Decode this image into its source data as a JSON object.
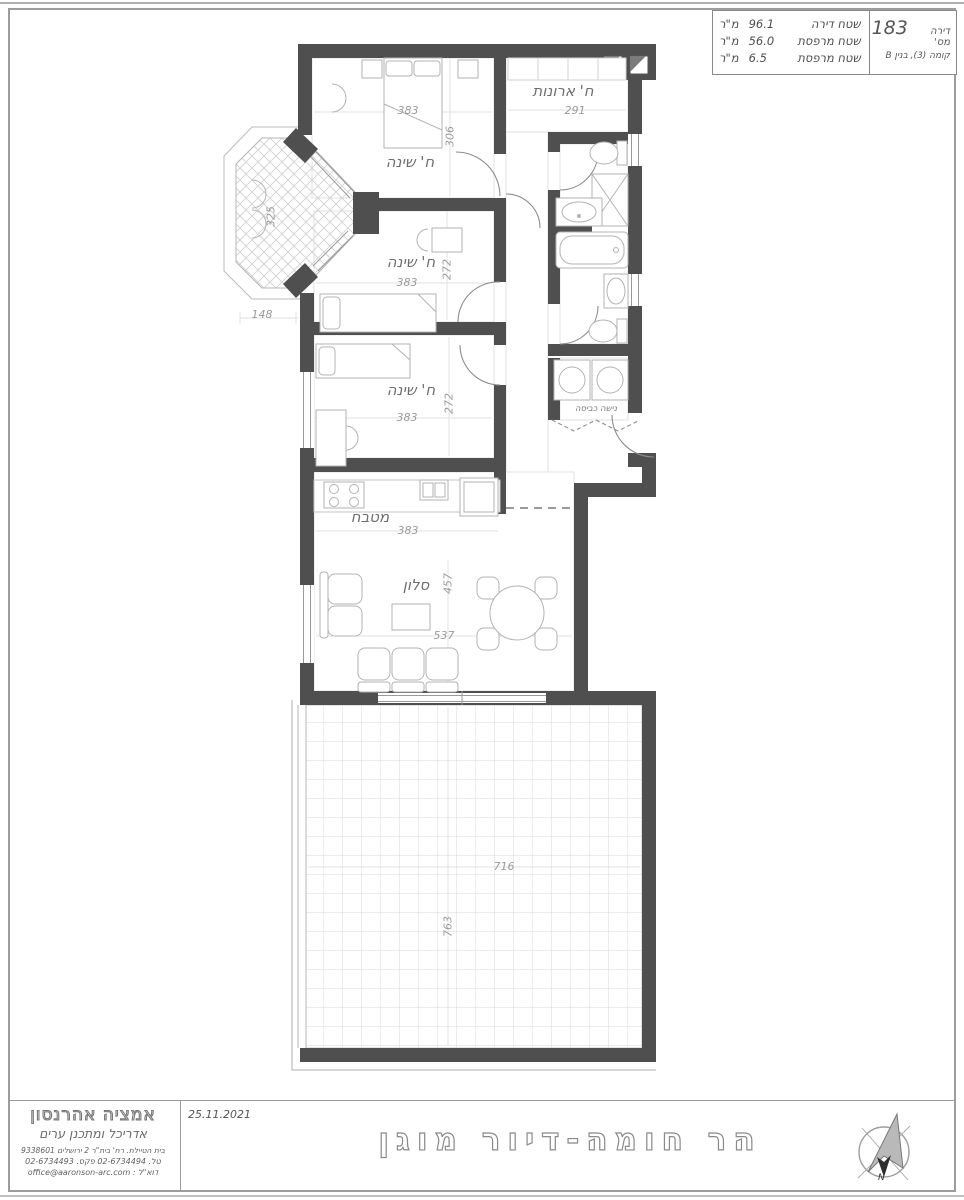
{
  "title_block": {
    "apartment_label": "דירה מס'",
    "apartment_number": "183",
    "floor_building": "קומה (3), בנין B",
    "areas": [
      {
        "label": "שטח דירה",
        "value": "96.1",
        "unit": "מ\"ר"
      },
      {
        "label": "שטח מרפסת",
        "value": "56.0",
        "unit": "מ\"ר"
      },
      {
        "label": "שטח מרפסת",
        "value": "6.5",
        "unit": "מ\"ר"
      }
    ]
  },
  "rooms": {
    "bedroom1": {
      "label": "ח' שינה",
      "width": "383",
      "height": "306"
    },
    "bedroom2": {
      "label": "ח' שינה",
      "width": "383",
      "height": "272"
    },
    "bedroom3": {
      "label": "ח' שינה",
      "width": "383",
      "height": "272"
    },
    "closet": {
      "label": "ח' ארונות",
      "width": "291"
    },
    "kitchen": {
      "label": "מטבח",
      "width": "383"
    },
    "living": {
      "label": "סלון",
      "width": "537",
      "height": "457"
    },
    "laundry": {
      "label": "נישה כביסה"
    },
    "balcony": {
      "height": "325"
    },
    "terrace": {
      "width": "716",
      "height": "763"
    },
    "offset_dim": "148"
  },
  "footer": {
    "date": "25.11.2021",
    "project_title": "הר חומה-דיור מוגן",
    "north_label": "N",
    "architect": {
      "name": "אמציה אהרנסון",
      "title": "אדריכל ומתכנן ערים",
      "address": "בית הטיילת. רח' בית\"ר 2 ירושלים 9338601",
      "phones": "טל. 02-6734494 פקס. 02-6734493",
      "email": "דוא\"ל : office@aaronson-arc.com"
    }
  }
}
